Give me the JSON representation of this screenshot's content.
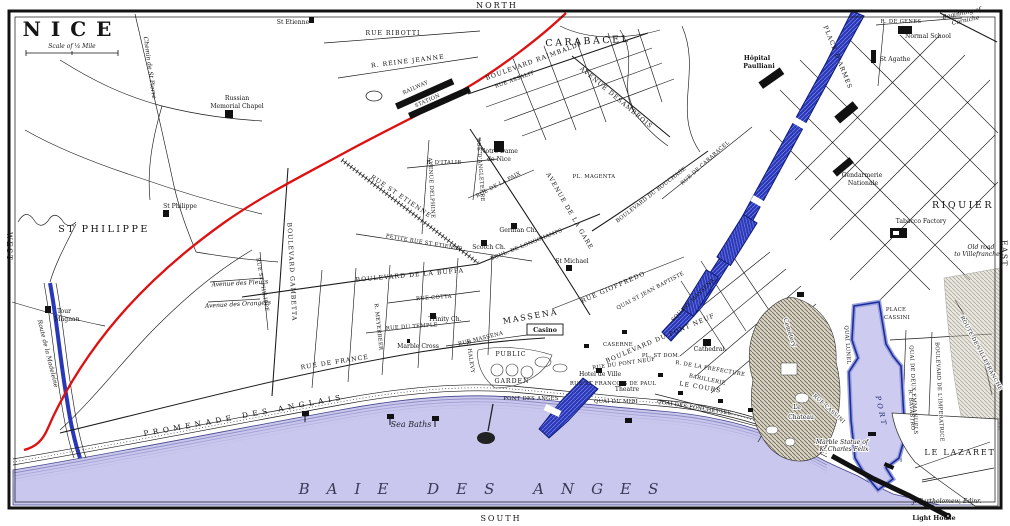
{
  "map": {
    "title": "NICE",
    "scale_label": "Scale of ¼ Mile",
    "promenade_label": "PROMENADE DES ANGLAIS",
    "credit_note": "J. Bartholomew, Edinr.",
    "compass": {
      "north": "NORTH",
      "south": "SOUTH",
      "east": "EAST",
      "west": "WEST"
    },
    "colors": {
      "sea": "#c9c7ee",
      "river": "#2a38b8",
      "railway": "#dd1111",
      "ink": "#141414"
    },
    "labels": [
      {
        "name": "district-st-philippe",
        "text": "ST PHILIPPE",
        "x": 104,
        "y": 232,
        "cls": "districtL"
      },
      {
        "name": "district-carabacel",
        "text": "CARABACEL",
        "x": 588,
        "y": 44,
        "rot": -3,
        "cls": "districtL"
      },
      {
        "name": "district-riquier",
        "text": "RIQUIER",
        "x": 963,
        "y": 208,
        "cls": "districtL"
      },
      {
        "name": "district-massena",
        "text": "MASSENA",
        "x": 531,
        "y": 319,
        "rot": -10,
        "cls": "district"
      },
      {
        "name": "district-le-lazaret",
        "text": "LE LAZARET",
        "x": 960,
        "y": 455,
        "cls": "district"
      },
      {
        "name": "bay-label",
        "text": "BAIE DES ANGES",
        "x": 487,
        "y": 494,
        "cls": "sea"
      },
      {
        "name": "le-chateau-line1",
        "text": "Le",
        "x": 797,
        "y": 409,
        "cls": "poi halo"
      },
      {
        "name": "le-chateau-line2",
        "text": "Chateau",
        "x": 801,
        "y": 419,
        "cls": "poi halo"
      },
      {
        "name": "place-darmes",
        "text": "PLACE D'ARMES",
        "x": 836,
        "y": 58,
        "rot": 68,
        "cls": "street"
      },
      {
        "name": "place-cassini-line1",
        "text": "PLACE",
        "x": 896,
        "y": 311,
        "cls": "tiny",
        "ls": 1.5
      },
      {
        "name": "place-cassini-line2",
        "text": "CASSINI",
        "x": 897,
        "y": 319,
        "cls": "tiny",
        "ls": 1.5
      },
      {
        "name": "le-cours",
        "text": "LE COURS",
        "x": 700,
        "y": 389,
        "rot": 10,
        "cls": "street"
      },
      {
        "name": "sea-baths",
        "text": "Sea Baths",
        "x": 411,
        "y": 427,
        "cls": "water-i"
      },
      {
        "name": "pont-des-anges",
        "text": "PONT DES ANGES",
        "x": 531,
        "y": 400,
        "cls": "tiny"
      },
      {
        "name": "quai-du-midi",
        "text": "QUAI DU MIDI",
        "x": 616,
        "y": 403,
        "cls": "tiny",
        "ls": 2
      },
      {
        "name": "quai-des-ponchettes",
        "text": "QUAI DES PONCHETTES",
        "x": 694,
        "y": 409,
        "rot": 9,
        "cls": "tiny",
        "ls": 1
      },
      {
        "name": "rue-de-france",
        "text": "RUE DE FRANCE",
        "x": 335,
        "y": 364,
        "rot": -9,
        "cls": "street"
      },
      {
        "name": "blvd-de-la-buffa",
        "text": "BOULEVARD DE LA BUFFA",
        "x": 410,
        "y": 277,
        "rot": -5,
        "cls": "street"
      },
      {
        "name": "blvd-de-longchamps",
        "text": "BOUL. DE LONGCHAMPS",
        "x": 527,
        "y": 246,
        "rot": -22,
        "cls": "tiny"
      },
      {
        "name": "rue-st-etienne",
        "text": "RUE ST ETIENNE",
        "x": 400,
        "y": 198,
        "rot": 34,
        "cls": "street"
      },
      {
        "name": "petite-rue-st-etienne",
        "text": "PETITE RUE ST ETIENNE",
        "x": 424,
        "y": 244,
        "rot": 10,
        "cls": "tiny"
      },
      {
        "name": "rue-cotta",
        "text": "RUE COTTA",
        "x": 434,
        "y": 299,
        "rot": -4,
        "cls": "tiny"
      },
      {
        "name": "rue-du-temple",
        "text": "RUE DU TEMPLE",
        "x": 412,
        "y": 328,
        "rot": -4,
        "cls": "tiny"
      },
      {
        "name": "marble-cross",
        "text": "Marble Cross",
        "x": 418,
        "y": 348,
        "cls": "poi"
      },
      {
        "name": "trinity-church",
        "text": "Trinity Ch.",
        "x": 445,
        "y": 321,
        "cls": "poi"
      },
      {
        "name": "rue-st-philippe",
        "text": "RUE ST PHILIPPE",
        "x": 261,
        "y": 285,
        "rot": 80,
        "cls": "tiny"
      },
      {
        "name": "blvd-gambetta",
        "text": "BOULEVARD GAMBETTA",
        "x": 290,
        "y": 272,
        "rot": 87,
        "cls": "street"
      },
      {
        "name": "rue-meyerbeer",
        "text": "R. MEYERBEER",
        "x": 377,
        "y": 327,
        "rot": 84,
        "cls": "tiny"
      },
      {
        "name": "rue-massena",
        "text": "RUE MASSENA",
        "x": 481,
        "y": 340,
        "rot": -14,
        "cls": "tiny"
      },
      {
        "name": "rue-halevy",
        "text": "R. HALEVY",
        "x": 469,
        "y": 357,
        "rot": 82,
        "cls": "tiny"
      },
      {
        "name": "public-garden-line1",
        "text": "PUBLIC",
        "x": 511,
        "y": 356,
        "cls": "street"
      },
      {
        "name": "public-garden-line2",
        "text": "GARDEN",
        "x": 512,
        "y": 383,
        "cls": "street"
      },
      {
        "name": "casino",
        "text": "Casino",
        "x": 545,
        "y": 332,
        "cls": "poi-b"
      },
      {
        "name": "square-massena",
        "text": "SQUARE MASSENA",
        "x": 694,
        "y": 301,
        "rot": -45,
        "cls": "tiny"
      },
      {
        "name": "quai-st-jean-baptiste",
        "text": "QUAI ST JEAN BAPTISTE",
        "x": 651,
        "y": 292,
        "rot": -28,
        "cls": "tiny"
      },
      {
        "name": "blvd-du-pont-neuf",
        "text": "BOULEVARD DU PONT NEUF",
        "x": 661,
        "y": 340,
        "rot": -23,
        "cls": "street"
      },
      {
        "name": "rue-du-pont-neuf",
        "text": "RUE DU PONT NEUF",
        "x": 624,
        "y": 365,
        "rot": -8,
        "cls": "tiny"
      },
      {
        "name": "pl-st-dom",
        "text": "PL. ST DOM.",
        "x": 661,
        "y": 357,
        "cls": "tiny"
      },
      {
        "name": "cathedral",
        "text": "Cathedral",
        "x": 709,
        "y": 351,
        "cls": "poi"
      },
      {
        "name": "rue-de-la-prefecture",
        "text": "R. DE LA PREFECTURE",
        "x": 710,
        "y": 370,
        "rot": 10,
        "cls": "tiny"
      },
      {
        "name": "barillerie",
        "text": "BARILLERIE",
        "x": 707,
        "y": 381,
        "rot": 12,
        "cls": "tiny"
      },
      {
        "name": "theatre",
        "text": "Theatre",
        "x": 627,
        "y": 391,
        "cls": "poi"
      },
      {
        "name": "hotel-de-ville",
        "text": "Hotel de Ville",
        "x": 600,
        "y": 376,
        "cls": "poi"
      },
      {
        "name": "caserne",
        "text": "CASERNE",
        "x": 618,
        "y": 346,
        "cls": "tiny"
      },
      {
        "name": "rue-st-francois-de-paul",
        "text": "RUE ST FRANCOIS DE PAUL",
        "x": 613,
        "y": 385,
        "cls": "tiny"
      },
      {
        "name": "rue-gioffredo",
        "text": "RUE GIOFFREDO",
        "x": 614,
        "y": 289,
        "rot": -24,
        "cls": "street"
      },
      {
        "name": "avenue-de-la-gare",
        "text": "AVENUE DE LA GARE",
        "x": 568,
        "y": 212,
        "rot": 60,
        "cls": "street"
      },
      {
        "name": "blvd-du-bouchage",
        "text": "BOULEVARD DU BOUCHAGE",
        "x": 652,
        "y": 196,
        "rot": -38,
        "cls": "tiny"
      },
      {
        "name": "rue-de-carabacel",
        "text": "RUE DE CARABACEL",
        "x": 706,
        "y": 164,
        "rot": -42,
        "cls": "tiny"
      },
      {
        "name": "avenue-desambrois",
        "text": "AVENUE DESAMBROIS",
        "x": 615,
        "y": 99,
        "rot": 40,
        "cls": "street"
      },
      {
        "name": "blvd-raimbaldi",
        "text": "BOULEVARD RAIMBALDI",
        "x": 534,
        "y": 63,
        "rot": -20,
        "cls": "street"
      },
      {
        "name": "rue-assalit",
        "text": "RUE ASSALIT",
        "x": 515,
        "y": 81,
        "rot": -20,
        "cls": "tiny"
      },
      {
        "name": "rue-reine-jeanne",
        "text": "R. REINE JEANNE",
        "x": 408,
        "y": 63,
        "rot": -7,
        "cls": "street"
      },
      {
        "name": "rue-ribotti",
        "text": "RUE RIBOTTI",
        "x": 393,
        "y": 35,
        "cls": "street",
        "ls": 3
      },
      {
        "name": "railway-station-line1",
        "text": "RAILWAY",
        "x": 416,
        "y": 89,
        "rot": -24,
        "cls": "tiny",
        "ls": 1.5
      },
      {
        "name": "railway-station-line2",
        "text": "STATION",
        "x": 428,
        "y": 102,
        "rot": -24,
        "cls": "tiny",
        "ls": 1.5
      },
      {
        "name": "chemin-de-st-pierre",
        "text": "Chemin de St Pierre",
        "x": 148,
        "y": 68,
        "rot": 82,
        "cls": "poi-i"
      },
      {
        "name": "st-etienne",
        "text": "St Etienne",
        "x": 293,
        "y": 24,
        "cls": "poi"
      },
      {
        "name": "russian-chapel-line1",
        "text": "Russian",
        "x": 237,
        "y": 100,
        "cls": "poi"
      },
      {
        "name": "russian-chapel-line2",
        "text": "Memorial Chapel",
        "x": 237,
        "y": 108,
        "cls": "poi"
      },
      {
        "name": "st-philippe-church",
        "text": "St Philippe",
        "x": 180,
        "y": 208,
        "cls": "poi"
      },
      {
        "name": "tour-magnan-line1",
        "text": "Tour",
        "x": 64,
        "y": 313,
        "cls": "poi"
      },
      {
        "name": "tour-magnan-line2",
        "text": "Magnan",
        "x": 67,
        "y": 321,
        "cls": "poi"
      },
      {
        "name": "route-de-la-madeleine",
        "text": "Route de la Madeleine",
        "x": 46,
        "y": 354,
        "rot": 76,
        "cls": "poi-i"
      },
      {
        "name": "avenue-des-fleurs",
        "text": "Avenue des Fleurs",
        "x": 240,
        "y": 285,
        "rot": -3,
        "cls": "poi-i"
      },
      {
        "name": "avenue-des-orangers",
        "text": "Avenue des Orangers",
        "x": 238,
        "y": 306,
        "rot": -3,
        "cls": "poi-i"
      },
      {
        "name": "hopital-paulliani-line1",
        "text": "Hôpital",
        "x": 757,
        "y": 60,
        "cls": "poi-b"
      },
      {
        "name": "hopital-paulliani-line2",
        "text": "Paulliani",
        "x": 759,
        "y": 68,
        "cls": "poi-b"
      },
      {
        "name": "rue-de-genes",
        "text": "R. DE GENES",
        "x": 901,
        "y": 23,
        "cls": "tiny",
        "ls": 1
      },
      {
        "name": "normal-school",
        "text": "Normal School",
        "x": 928,
        "y": 38,
        "cls": "poi"
      },
      {
        "name": "st-agathe",
        "text": "St Agathe",
        "x": 895,
        "y": 61,
        "cls": "poi"
      },
      {
        "name": "corniche-line1",
        "text": "Beginning of",
        "x": 962,
        "y": 15,
        "rot": -12,
        "cls": "poi-i"
      },
      {
        "name": "corniche-line2",
        "text": "Corniche",
        "x": 966,
        "y": 22,
        "rot": -12,
        "cls": "poi-i"
      },
      {
        "name": "gendarmerie-line1",
        "text": "Gendarmerie",
        "x": 862,
        "y": 177,
        "cls": "poi"
      },
      {
        "name": "gendarmerie-line2",
        "text": "Nationale",
        "x": 863,
        "y": 185,
        "cls": "poi"
      },
      {
        "name": "tabacco-factory",
        "text": "Tabacco Factory",
        "x": 921,
        "y": 223,
        "cls": "poi"
      },
      {
        "name": "old-road-line1",
        "text": "Old road",
        "x": 981,
        "y": 249,
        "cls": "poi-i"
      },
      {
        "name": "old-road-line2",
        "text": "to Villefranche",
        "x": 977,
        "y": 256,
        "cls": "poi-i"
      },
      {
        "name": "rue-cassini",
        "text": "RUE CASSINI",
        "x": 828,
        "y": 410,
        "rot": 42,
        "cls": "tiny halo"
      },
      {
        "name": "rue-bavastro",
        "text": "R. BAVASTRO",
        "x": 910,
        "y": 410,
        "rot": 86,
        "cls": "tiny"
      },
      {
        "name": "quai-lunel",
        "text": "QUAI LUNEL",
        "x": 846,
        "y": 345,
        "rot": 86,
        "cls": "tiny"
      },
      {
        "name": "quai-de-deux-emmanuels",
        "text": "QUAI DE DEUX EMMANUELS",
        "x": 912,
        "y": 390,
        "rot": 87,
        "cls": "tiny"
      },
      {
        "name": "blvd-imperatrice",
        "text": "BOULEVARD DE L'IMPERATRICE",
        "x": 938,
        "y": 392,
        "rot": 87,
        "cls": "tiny halo"
      },
      {
        "name": "port-label",
        "text": "PORT",
        "x": 879,
        "y": 412,
        "rot": 78,
        "cls": "water-caps"
      },
      {
        "name": "route-de-villefranche",
        "text": "ROUTE DE VILLEFRANCHE",
        "x": 980,
        "y": 354,
        "rot": 62,
        "cls": "tiny halo"
      },
      {
        "name": "cemetery",
        "text": "Cemetery",
        "x": 788,
        "y": 333,
        "rot": 72,
        "cls": "poi halo"
      },
      {
        "name": "marble-statue-line1",
        "text": "Marble Statue of",
        "x": 842,
        "y": 444,
        "cls": "poi-i halo"
      },
      {
        "name": "marble-statue-line2",
        "text": "K. Charles Felix",
        "x": 844,
        "y": 451,
        "cls": "poi-i halo"
      },
      {
        "name": "light-house",
        "text": "Light House",
        "x": 934,
        "y": 520,
        "cls": "poi-b"
      },
      {
        "name": "map-credit",
        "text": "J. Bartholomew, Edinr.",
        "x": 947,
        "y": 503,
        "cls": "poi-i"
      },
      {
        "name": "rue-dangleterre",
        "text": "RUE D'ANGLETERRE",
        "x": 479,
        "y": 170,
        "rot": 86,
        "cls": "tiny"
      },
      {
        "name": "avenue-delphine",
        "text": "AVENUE DELPHINE",
        "x": 430,
        "y": 188,
        "rot": 87,
        "cls": "tiny"
      },
      {
        "name": "rue-ditalie",
        "text": "R. D'ITALIE",
        "x": 444,
        "y": 164,
        "cls": "tiny"
      },
      {
        "name": "rue-de-la-paix",
        "text": "RUE DE LA PAIX",
        "x": 499,
        "y": 186,
        "rot": -28,
        "cls": "tiny"
      },
      {
        "name": "notre-dame-line1",
        "text": "Notre Dame",
        "x": 499,
        "y": 153,
        "cls": "poi"
      },
      {
        "name": "notre-dame-line2",
        "text": "de Nice",
        "x": 499,
        "y": 161,
        "cls": "poi"
      },
      {
        "name": "scotch-church",
        "text": "Scotch Ch.",
        "x": 489,
        "y": 249,
        "cls": "poi"
      },
      {
        "name": "german-church",
        "text": "German Ch.",
        "x": 518,
        "y": 232,
        "cls": "poi"
      },
      {
        "name": "st-michael",
        "text": "St Michael",
        "x": 572,
        "y": 263,
        "cls": "poi"
      },
      {
        "name": "pl-magenta",
        "text": "PL. MAGENTA",
        "x": 594,
        "y": 178,
        "cls": "tiny"
      }
    ]
  }
}
